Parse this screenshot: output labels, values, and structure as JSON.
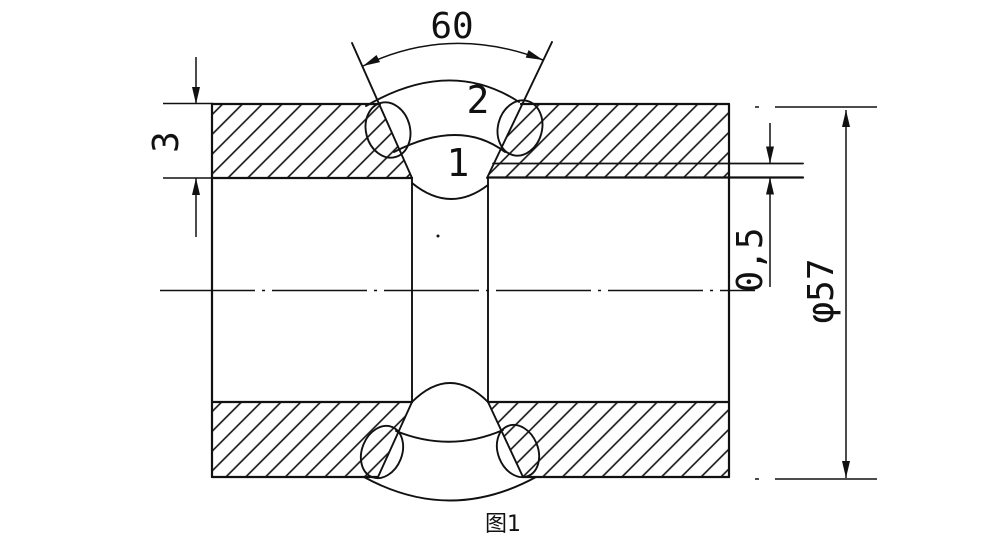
{
  "figure": {
    "caption": "图1",
    "description": "pipe butt weld joint cross-section drawing"
  },
  "drawing": {
    "colors": {
      "line": "#111111",
      "background": "#ffffff"
    },
    "dimensions": {
      "groove_angle": "60",
      "wall_thickness": "3",
      "root_height": "0,5",
      "pipe_diameter": "φ57"
    },
    "weld_passes": {
      "root_pass": "1",
      "cover_pass": "2"
    }
  }
}
